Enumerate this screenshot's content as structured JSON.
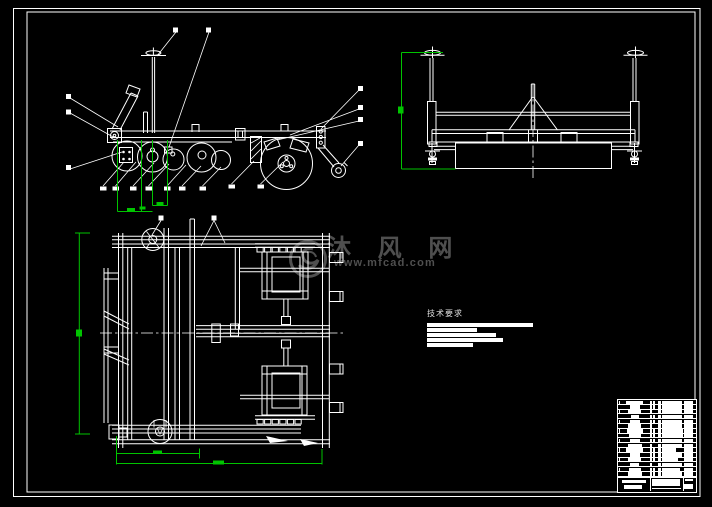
{
  "document": {
    "kind": "CAD engineering assembly drawing preview",
    "background_color": "#000000",
    "line_color": "#ffffff",
    "dimension_color": "#00c400",
    "watermark_color": "#4f4f4f"
  },
  "watermark": {
    "brand_characters": "沐 风 网",
    "website": "www.mfcad.com"
  },
  "tech_requirements": {
    "heading": "技术要求",
    "redacted_line_widths_px": [
      106,
      50,
      69,
      76,
      46
    ]
  },
  "title_block": {
    "rows": [
      {
        "tick": 1,
        "name_w": 17,
        "c3": 1,
        "c4": 1,
        "detail_w": 20,
        "note_w": 9.5
      },
      {
        "tick": 0,
        "name_w": 10,
        "c3": 1,
        "c4": 1,
        "detail_w": 20,
        "note_w": 9.5
      },
      {
        "tick": 1,
        "name_w": 13,
        "c3": 1,
        "c4": 0,
        "detail_w": 20,
        "note_w": 9.5
      },
      {
        "tick": 0,
        "name_w": 8,
        "c3": 1,
        "c4": 1,
        "detail_w": 20,
        "note_w": 9.5
      },
      {
        "tick": 1,
        "name_w": 10,
        "c3": 1,
        "c4": 1,
        "detail_w": 20,
        "note_w": 9.5
      },
      {
        "tick": 0,
        "name_w": 13,
        "c3": 1,
        "c4": 0,
        "detail_w": 20,
        "note_w": 9.5
      },
      {
        "tick": 1,
        "name_w": 16,
        "c3": 1,
        "c4": 1,
        "detail_w": 21,
        "note_w": 9.5
      },
      {
        "tick": 0,
        "name_w": 12,
        "c3": 1,
        "c4": 1,
        "detail_w": 21,
        "note_w": 9.5
      },
      {
        "tick": 1,
        "name_w": 10,
        "c3": 1,
        "c4": 1,
        "detail_w": 20,
        "note_w": 9.5
      },
      {
        "tick": 0,
        "name_w": 14,
        "c3": 1,
        "c4": 0,
        "detail_w": 20,
        "note_w": 9.5
      },
      {
        "tick": 1,
        "name_w": 17,
        "c3": 1,
        "c4": 1,
        "detail_w": 14,
        "note_w": 9.5
      },
      {
        "tick": 0,
        "name_w": 10,
        "c3": 1,
        "c4": 1,
        "detail_w": 20,
        "note_w": 9.5
      },
      {
        "tick": 1,
        "name_w": 13,
        "c3": 1,
        "c4": 1,
        "detail_w": 16,
        "note_w": 9.5
      },
      {
        "tick": 0,
        "name_w": 9,
        "c3": 1,
        "c4": 0,
        "detail_w": 20,
        "note_w": 9.5
      },
      {
        "tick": 1,
        "name_w": 12,
        "c3": 1,
        "c4": 1,
        "detail_w": 18,
        "note_w": 9.5
      },
      {
        "tick": 0,
        "name_w": 14,
        "c3": 1,
        "c4": 1,
        "detail_w": 20,
        "note_w": 9.5
      }
    ]
  }
}
